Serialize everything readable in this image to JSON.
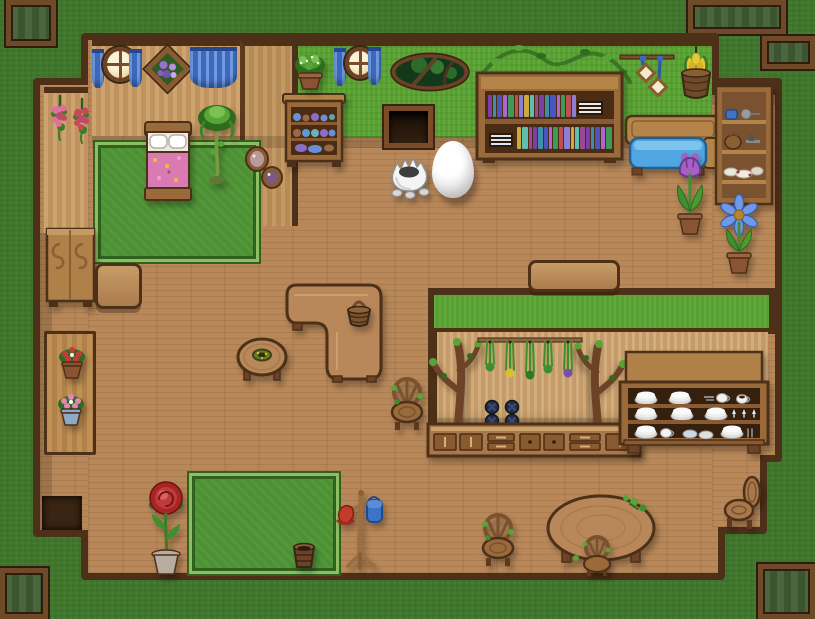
{
  "scene": {
    "canvas": {
      "width": 815,
      "height": 619
    },
    "palette": {
      "grass_outside": "#3e772a",
      "grass_wall": "#57a130",
      "floor_wood": "#b8885a",
      "wood_trim": "#4d3018",
      "wall_plank": "#cda46e",
      "kitchen_plank": "#d2ad7d",
      "curtain_blue": "#3e69bb",
      "cushion_blue": "#4fa6e0",
      "blanket_pink": "#da7ab2",
      "rug_green": "#4c9133",
      "exit_pad_green": "#49663c"
    },
    "book_colors": [
      "#7a3fa8",
      "#3f8fa8",
      "#4a55c0",
      "#b065d0",
      "#3f9a55",
      "#c05050",
      "#8a80d8",
      "#d0a840",
      "#5fc0b0",
      "#9a4a90"
    ]
  },
  "structure": {
    "pads": [
      {
        "name": "exit-pad-top-left",
        "x": 6,
        "y": 0,
        "w": 50,
        "h": 46
      },
      {
        "name": "exit-pad-top-right",
        "x": 688,
        "y": 0,
        "w": 98,
        "h": 34
      },
      {
        "name": "window-top-right",
        "x": 762,
        "y": 36,
        "w": 53,
        "h": 33
      },
      {
        "name": "exit-pad-bottom-left",
        "x": 0,
        "y": 568,
        "w": 48,
        "h": 51
      },
      {
        "name": "exit-pad-bottom-right",
        "x": 758,
        "y": 564,
        "w": 57,
        "h": 55
      }
    ],
    "floors": [
      {
        "name": "floor-top",
        "x": 88,
        "y": 40,
        "w": 624,
        "h": 185
      },
      {
        "name": "floor-left-corridor",
        "x": 40,
        "y": 85,
        "w": 48,
        "h": 445
      },
      {
        "name": "floor-main",
        "x": 88,
        "y": 225,
        "w": 630,
        "h": 348
      },
      {
        "name": "floor-right-wing",
        "x": 712,
        "y": 85,
        "w": 63,
        "h": 370
      },
      {
        "name": "floor-right-lower",
        "x": 712,
        "y": 455,
        "w": 48,
        "h": 72
      }
    ],
    "walls": [
      {
        "name": "bedroom-wall",
        "kind": "wood",
        "x": 92,
        "y": 40,
        "w": 148,
        "h": 96
      },
      {
        "name": "bedroom-side-wall",
        "kind": "pillar",
        "x": 240,
        "y": 40,
        "w": 58,
        "h": 186
      },
      {
        "name": "hall-wall",
        "kind": "green",
        "x": 298,
        "y": 40,
        "w": 414,
        "h": 98
      },
      {
        "name": "corridor-wall",
        "kind": "wood",
        "x": 44,
        "y": 87,
        "w": 44,
        "h": 146
      },
      {
        "name": "wing-beam",
        "kind": "beam",
        "x": 712,
        "y": 85,
        "w": 63,
        "h": 10
      },
      {
        "name": "kitchen-divider-wall",
        "kind": "divider",
        "x": 428,
        "y": 288,
        "w": 347,
        "h": 46
      },
      {
        "name": "kitchen-wall",
        "kind": "kitchen",
        "x": 436,
        "y": 332,
        "w": 332,
        "h": 96
      },
      {
        "name": "kitchen-west-beam",
        "kind": "beam",
        "x": 428,
        "y": 330,
        "w": 9,
        "h": 100
      }
    ],
    "shadows": [
      {
        "x": 92,
        "y": 136,
        "w": 620,
        "h": 12
      },
      {
        "x": 40,
        "y": 233,
        "w": 12,
        "h": 297
      },
      {
        "x": 712,
        "y": 95,
        "w": 63,
        "h": 10
      },
      {
        "x": 436,
        "y": 418,
        "w": 332,
        "h": 10
      },
      {
        "x": 95,
        "y": 142,
        "w": 26,
        "h": 120
      }
    ]
  },
  "objects": [
    {
      "name": "bedroom-curtain-left",
      "kind": "curtain",
      "x": 92,
      "y": 49,
      "w": 12,
      "h": 39,
      "inter": false
    },
    {
      "name": "bedroom-round-window",
      "kind": "window-round",
      "x": 103,
      "y": 47,
      "w": 34,
      "h": 35,
      "inter": false
    },
    {
      "name": "bedroom-curtain-right",
      "kind": "curtain",
      "x": 129,
      "y": 49,
      "w": 13,
      "h": 38,
      "inter": false
    },
    {
      "name": "flower-picture",
      "kind": "picture-diamond",
      "x": 146,
      "y": 46,
      "w": 43,
      "h": 46,
      "inter": false
    },
    {
      "name": "bedroom-curtain-wide",
      "kind": "curtain-wide",
      "x": 190,
      "y": 47,
      "w": 47,
      "h": 41,
      "inter": false
    },
    {
      "name": "hanging-flowers-1",
      "kind": "flower-hang",
      "x": 48,
      "y": 94,
      "w": 24,
      "h": 48,
      "colors": {
        "fl": "#e06fa0"
      },
      "inter": false
    },
    {
      "name": "hanging-flowers-2",
      "kind": "flower-hang",
      "x": 70,
      "y": 97,
      "w": 24,
      "h": 46,
      "colors": {
        "fl": "#c84858"
      },
      "inter": false
    },
    {
      "name": "bedroom-rug",
      "kind": "rug",
      "x": 95,
      "y": 142,
      "w": 164,
      "h": 120,
      "inter": false
    },
    {
      "name": "bed",
      "kind": "bed",
      "x": 143,
      "y": 122,
      "w": 50,
      "h": 80,
      "inter": true
    },
    {
      "name": "potted-palm",
      "kind": "palm",
      "x": 196,
      "y": 100,
      "w": 42,
      "h": 86,
      "inter": true
    },
    {
      "name": "portrait-large",
      "kind": "portrait",
      "x": 245,
      "y": 146,
      "w": 24,
      "h": 26,
      "colors": {
        "inner": "#b89a9a"
      },
      "inter": false
    },
    {
      "name": "portrait-small",
      "kind": "portrait",
      "x": 261,
      "y": 166,
      "w": 22,
      "h": 23,
      "colors": {
        "inner": "#7a5a80"
      },
      "inter": false
    },
    {
      "name": "hall-curtain-left",
      "kind": "curtain",
      "x": 334,
      "y": 48,
      "w": 12,
      "h": 38,
      "inter": false
    },
    {
      "name": "hall-round-window",
      "kind": "window-round",
      "x": 345,
      "y": 47,
      "w": 30,
      "h": 32,
      "inter": false
    },
    {
      "name": "hall-curtain-right",
      "kind": "curtain",
      "x": 368,
      "y": 47,
      "w": 13,
      "h": 38,
      "inter": false
    },
    {
      "name": "forest-oval-window",
      "kind": "window-oval",
      "x": 391,
      "y": 53,
      "w": 78,
      "h": 39,
      "inter": false
    },
    {
      "name": "vine-decor",
      "kind": "vine",
      "x": 479,
      "y": 40,
      "w": 152,
      "h": 56,
      "inter": false
    },
    {
      "name": "dish-cupboard",
      "kind": "cupboard",
      "x": 283,
      "y": 86,
      "w": 62,
      "h": 82,
      "inter": true
    },
    {
      "name": "cupboard-plant",
      "kind": "plant-top",
      "x": 287,
      "y": 50,
      "w": 46,
      "h": 40,
      "inter": false
    },
    {
      "name": "wall-opening",
      "kind": "doorway",
      "x": 384,
      "y": 106,
      "w": 49,
      "h": 42,
      "inter": true
    },
    {
      "name": "bookshelf",
      "kind": "bookshelf",
      "x": 477,
      "y": 71,
      "w": 145,
      "h": 92,
      "inter": true
    },
    {
      "name": "hanging-frames",
      "kind": "frames-hanging",
      "x": 620,
      "y": 45,
      "w": 54,
      "h": 52,
      "inter": false
    },
    {
      "name": "tulip-basket",
      "kind": "basket-hanging",
      "x": 676,
      "y": 47,
      "w": 40,
      "h": 58,
      "inter": false
    },
    {
      "name": "blue-bench",
      "kind": "bench-blue",
      "x": 624,
      "y": 116,
      "w": 98,
      "h": 62,
      "inter": true
    },
    {
      "name": "tool-shelf",
      "kind": "shelf-tools",
      "x": 716,
      "y": 86,
      "w": 56,
      "h": 122,
      "inter": true
    },
    {
      "name": "egg-creature",
      "kind": "egg-monster",
      "x": 386,
      "y": 146,
      "w": 48,
      "h": 52,
      "inter": true
    },
    {
      "name": "egg",
      "kind": "egg",
      "x": 432,
      "y": 141,
      "w": 42,
      "h": 57,
      "inter": true
    },
    {
      "name": "purple-tulip-pot",
      "kind": "plant-tulip",
      "x": 666,
      "y": 145,
      "w": 48,
      "h": 92,
      "colors": {
        "fl": "#a85fc4",
        "pot": "#8a5434"
      },
      "inter": true
    },
    {
      "name": "blue-flower-pot",
      "kind": "plant-daisy",
      "x": 714,
      "y": 193,
      "w": 50,
      "h": 90,
      "colors": {
        "fl": "#6f99e8",
        "pot": "#8a5434"
      },
      "inter": true
    },
    {
      "name": "wardrobe",
      "kind": "wardrobe",
      "x": 46,
      "y": 228,
      "w": 49,
      "h": 81,
      "inter": true
    },
    {
      "name": "side-table",
      "kind": "bench-wood",
      "x": 95,
      "y": 263,
      "w": 47,
      "h": 46,
      "inter": true
    },
    {
      "name": "ledge",
      "kind": "ledge",
      "x": 44,
      "y": 331,
      "w": 52,
      "h": 124,
      "inter": false
    },
    {
      "name": "red-flower-pot",
      "kind": "pot-flowers",
      "x": 55,
      "y": 342,
      "w": 34,
      "h": 38,
      "colors": {
        "fl": "#c43b3b",
        "pot": "#8a5434"
      },
      "inter": true
    },
    {
      "name": "pink-flower-pot",
      "kind": "pot-flowers",
      "x": 54,
      "y": 389,
      "w": 36,
      "h": 39,
      "colors": {
        "fl": "#e584b8",
        "pot": "#8fa8c8"
      },
      "inter": true
    },
    {
      "name": "divider-bench",
      "kind": "bench-wood",
      "x": 528,
      "y": 260,
      "w": 92,
      "h": 32,
      "inter": true
    },
    {
      "name": "l-shaped-table",
      "kind": "table-L",
      "x": 285,
      "y": 283,
      "w": 98,
      "h": 100,
      "inter": true
    },
    {
      "name": "basket",
      "kind": "basket",
      "x": 344,
      "y": 288,
      "w": 30,
      "h": 40,
      "inter": true
    },
    {
      "name": "round-table-nest",
      "kind": "table-round",
      "x": 236,
      "y": 333,
      "w": 52,
      "h": 50,
      "inter": true
    },
    {
      "name": "rustic-chair-1",
      "kind": "chair-rustic",
      "x": 385,
      "y": 376,
      "w": 44,
      "h": 56,
      "inter": true
    },
    {
      "name": "branch-left",
      "kind": "branch",
      "x": 428,
      "y": 330,
      "w": 56,
      "h": 98,
      "inter": false
    },
    {
      "name": "branch-right",
      "kind": "branch",
      "x": 582,
      "y": 332,
      "w": 46,
      "h": 95,
      "flip": true,
      "inter": false
    },
    {
      "name": "herb-rack",
      "kind": "herbs",
      "x": 478,
      "y": 334,
      "w": 104,
      "h": 44,
      "colors": {
        "bundles": "#3f8f2e|#d8c032|#2f7a26|#3f8f2e|#7a4fa8"
      },
      "inter": true
    },
    {
      "name": "stove",
      "kind": "stove",
      "x": 480,
      "y": 399,
      "w": 46,
      "h": 30,
      "inter": true
    },
    {
      "name": "kitchen-counter",
      "kind": "counter",
      "x": 428,
      "y": 424,
      "w": 212,
      "h": 32,
      "inter": true
    },
    {
      "name": "dish-hutch",
      "kind": "hutch",
      "x": 620,
      "y": 352,
      "w": 148,
      "h": 104,
      "inter": true
    },
    {
      "name": "entry-mat",
      "kind": "mat",
      "x": 42,
      "y": 496,
      "w": 40,
      "h": 34,
      "inter": false
    },
    {
      "name": "rose-pot",
      "kind": "plant-rose",
      "x": 140,
      "y": 476,
      "w": 52,
      "h": 102,
      "colors": {
        "fl": "#c22f2f",
        "pot": "#b8aca0"
      },
      "inter": true
    },
    {
      "name": "bottom-rug",
      "kind": "rug",
      "x": 189,
      "y": 473,
      "w": 150,
      "h": 101,
      "inter": false
    },
    {
      "name": "bucket",
      "kind": "bucket",
      "x": 290,
      "y": 541,
      "w": 28,
      "h": 30,
      "inter": true
    },
    {
      "name": "coat-rack",
      "kind": "coat-rack",
      "x": 334,
      "y": 486,
      "w": 52,
      "h": 84,
      "inter": true
    },
    {
      "name": "rustic-chair-2",
      "kind": "chair-rustic",
      "x": 476,
      "y": 512,
      "w": 52,
      "h": 62,
      "inter": true
    },
    {
      "name": "oval-table",
      "kind": "table-oval",
      "x": 546,
      "y": 494,
      "w": 110,
      "h": 78,
      "inter": true
    },
    {
      "name": "small-chair",
      "kind": "chair-back",
      "x": 577,
      "y": 534,
      "w": 40,
      "h": 42,
      "inter": true
    },
    {
      "name": "corner-chair",
      "kind": "chair-side",
      "x": 721,
      "y": 474,
      "w": 42,
      "h": 58,
      "inter": true
    }
  ]
}
